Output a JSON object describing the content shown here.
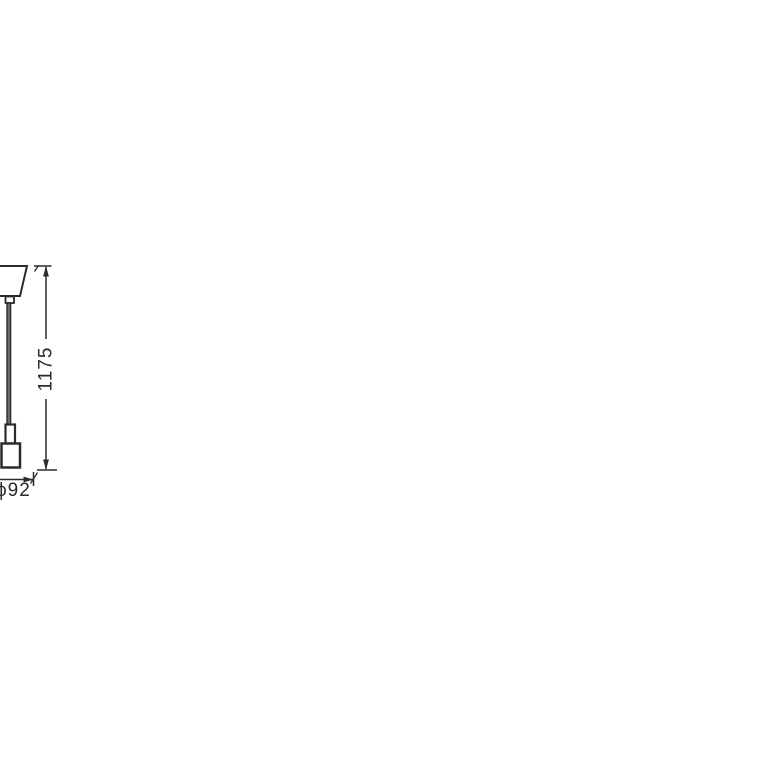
{
  "colors": {
    "line": "#2b2b2b",
    "background": "#ffffff",
    "cord_fill": "#6e6e6e",
    "label_text": "#2a2a2a"
  },
  "dimensions": {
    "height": {
      "label": "1175"
    },
    "diameter": {
      "label": "ϕ92"
    }
  }
}
